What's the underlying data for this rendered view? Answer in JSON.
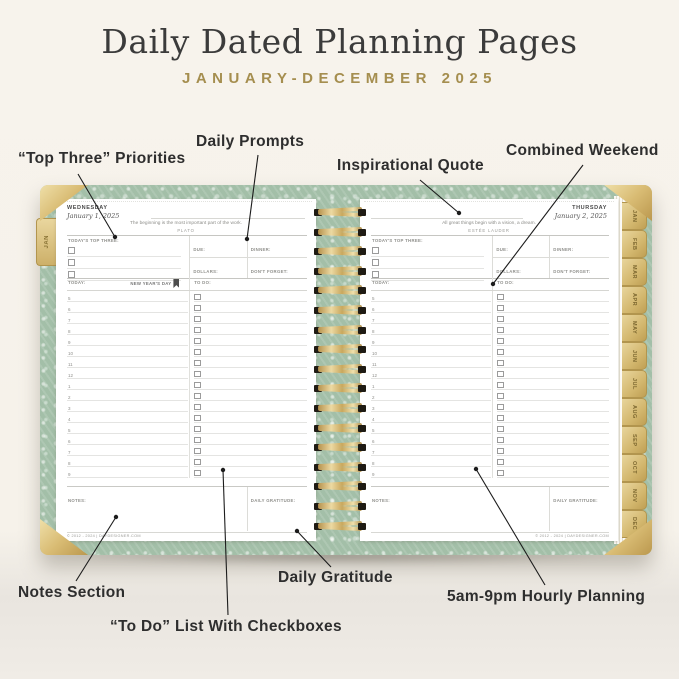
{
  "header": {
    "title": "Daily Dated Planning Pages",
    "subtitle": "JANUARY-DECEMBER 2025"
  },
  "colors": {
    "accent_gold": "#a58e4f",
    "cover_sage": "#a3bfa8",
    "title_ink": "#3b3b3b",
    "annotation_ink": "#2e2e2e"
  },
  "annotations": [
    {
      "label": "“Top Three” Priorities",
      "x": 18,
      "y": 150,
      "line": {
        "x1": 78,
        "y1": 174,
        "x2": 115,
        "y2": 237
      }
    },
    {
      "label": "Daily Prompts",
      "x": 196,
      "y": 133,
      "line": {
        "x1": 258,
        "y1": 155,
        "x2": 247,
        "y2": 239
      }
    },
    {
      "label": "Inspirational Quote",
      "x": 337,
      "y": 157,
      "line": {
        "x1": 420,
        "y1": 180,
        "x2": 459,
        "y2": 213
      }
    },
    {
      "label": "Combined Weekend",
      "x": 506,
      "y": 142,
      "line": {
        "x1": 583,
        "y1": 165,
        "x2": 493,
        "y2": 284
      }
    },
    {
      "label": "Notes Section",
      "x": 18,
      "y": 584,
      "line": {
        "x1": 76,
        "y1": 581,
        "x2": 116,
        "y2": 517
      }
    },
    {
      "label": "“To Do” List With Checkboxes",
      "x": 110,
      "y": 618,
      "line": {
        "x1": 228,
        "y1": 615,
        "x2": 223,
        "y2": 470
      }
    },
    {
      "label": "Daily Gratitude",
      "x": 278,
      "y": 569,
      "line": {
        "x1": 331,
        "y1": 567,
        "x2": 297,
        "y2": 531
      }
    },
    {
      "label": "5am-9pm Hourly Planning",
      "x": 447,
      "y": 588,
      "line": {
        "x1": 545,
        "y1": 585,
        "x2": 476,
        "y2": 469
      }
    }
  ],
  "planner": {
    "hours": [
      "5",
      "6",
      "7",
      "8",
      "9",
      "10",
      "11",
      "12",
      "1",
      "2",
      "3",
      "4",
      "5",
      "6",
      "7",
      "8",
      "9"
    ],
    "coil_count": 17,
    "month_tabs": [
      "JAN",
      "FEB",
      "MAR",
      "APR",
      "MAY",
      "JUN",
      "JUL",
      "AUG",
      "SEP",
      "OCT",
      "NOV",
      "DEC"
    ],
    "left_edge_tab": "JAN",
    "left_page": {
      "day_name": "WEDNESDAY",
      "date": "January 1, 2025",
      "quote": "The beginning is the most important part of the work.",
      "quote_author": "PLATO",
      "top_three_label": "TODAY'S TOP THREE:",
      "due_label": "DUE:",
      "dinner_label": "DINNER:",
      "dollars_label": "DOLLARS:",
      "dont_forget_label": "DON'T FORGET:",
      "today_label": "TODAY:",
      "holiday": "NEW YEAR'S DAY",
      "todo_label": "TO DO:",
      "notes_label": "NOTES:",
      "gratitude_label": "DAILY GRATITUDE:",
      "footer": "© 2012 - 2024 | DAYDESIGNER.COM"
    },
    "right_page": {
      "day_name": "THURSDAY",
      "date": "January 2, 2025",
      "quote": "All great things begin with a vision, a dream.",
      "quote_author": "ESTÉE LAUDER",
      "top_three_label": "TODAY'S TOP THREE:",
      "due_label": "DUE:",
      "dinner_label": "DINNER:",
      "dollars_label": "DOLLARS:",
      "dont_forget_label": "DON'T FORGET:",
      "today_label": "TODAY:",
      "holiday": "",
      "todo_label": "TO DO:",
      "notes_label": "NOTES:",
      "gratitude_label": "DAILY GRATITUDE:",
      "footer": "© 2012 - 2024 | DAYDESIGNER.COM"
    }
  }
}
